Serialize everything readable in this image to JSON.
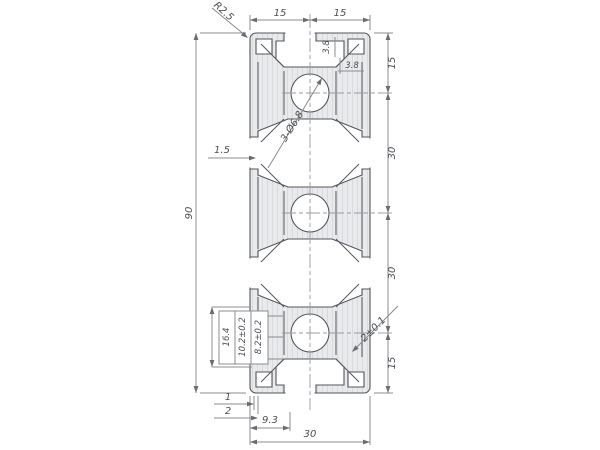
{
  "drawing": {
    "dims": {
      "top": [
        "15",
        "15"
      ],
      "right": [
        "15",
        "30",
        "30",
        "15"
      ],
      "left": "90",
      "bottom": [
        "1",
        "2",
        "9.3",
        "30"
      ],
      "radius": "R2.5",
      "hole": "3-Ø6.8",
      "wall": "1.5",
      "stack": [
        "16.4",
        "10.2±0.2",
        "8.2±0.2"
      ],
      "flange": "2±0.1",
      "boss": [
        "3.8",
        "3.8"
      ]
    },
    "colors": {
      "body": "#e9eaec",
      "hatch": "#d9dadd",
      "outline": "#54565c",
      "dimline": "#8a8c90",
      "text": "#4c4e54"
    }
  }
}
